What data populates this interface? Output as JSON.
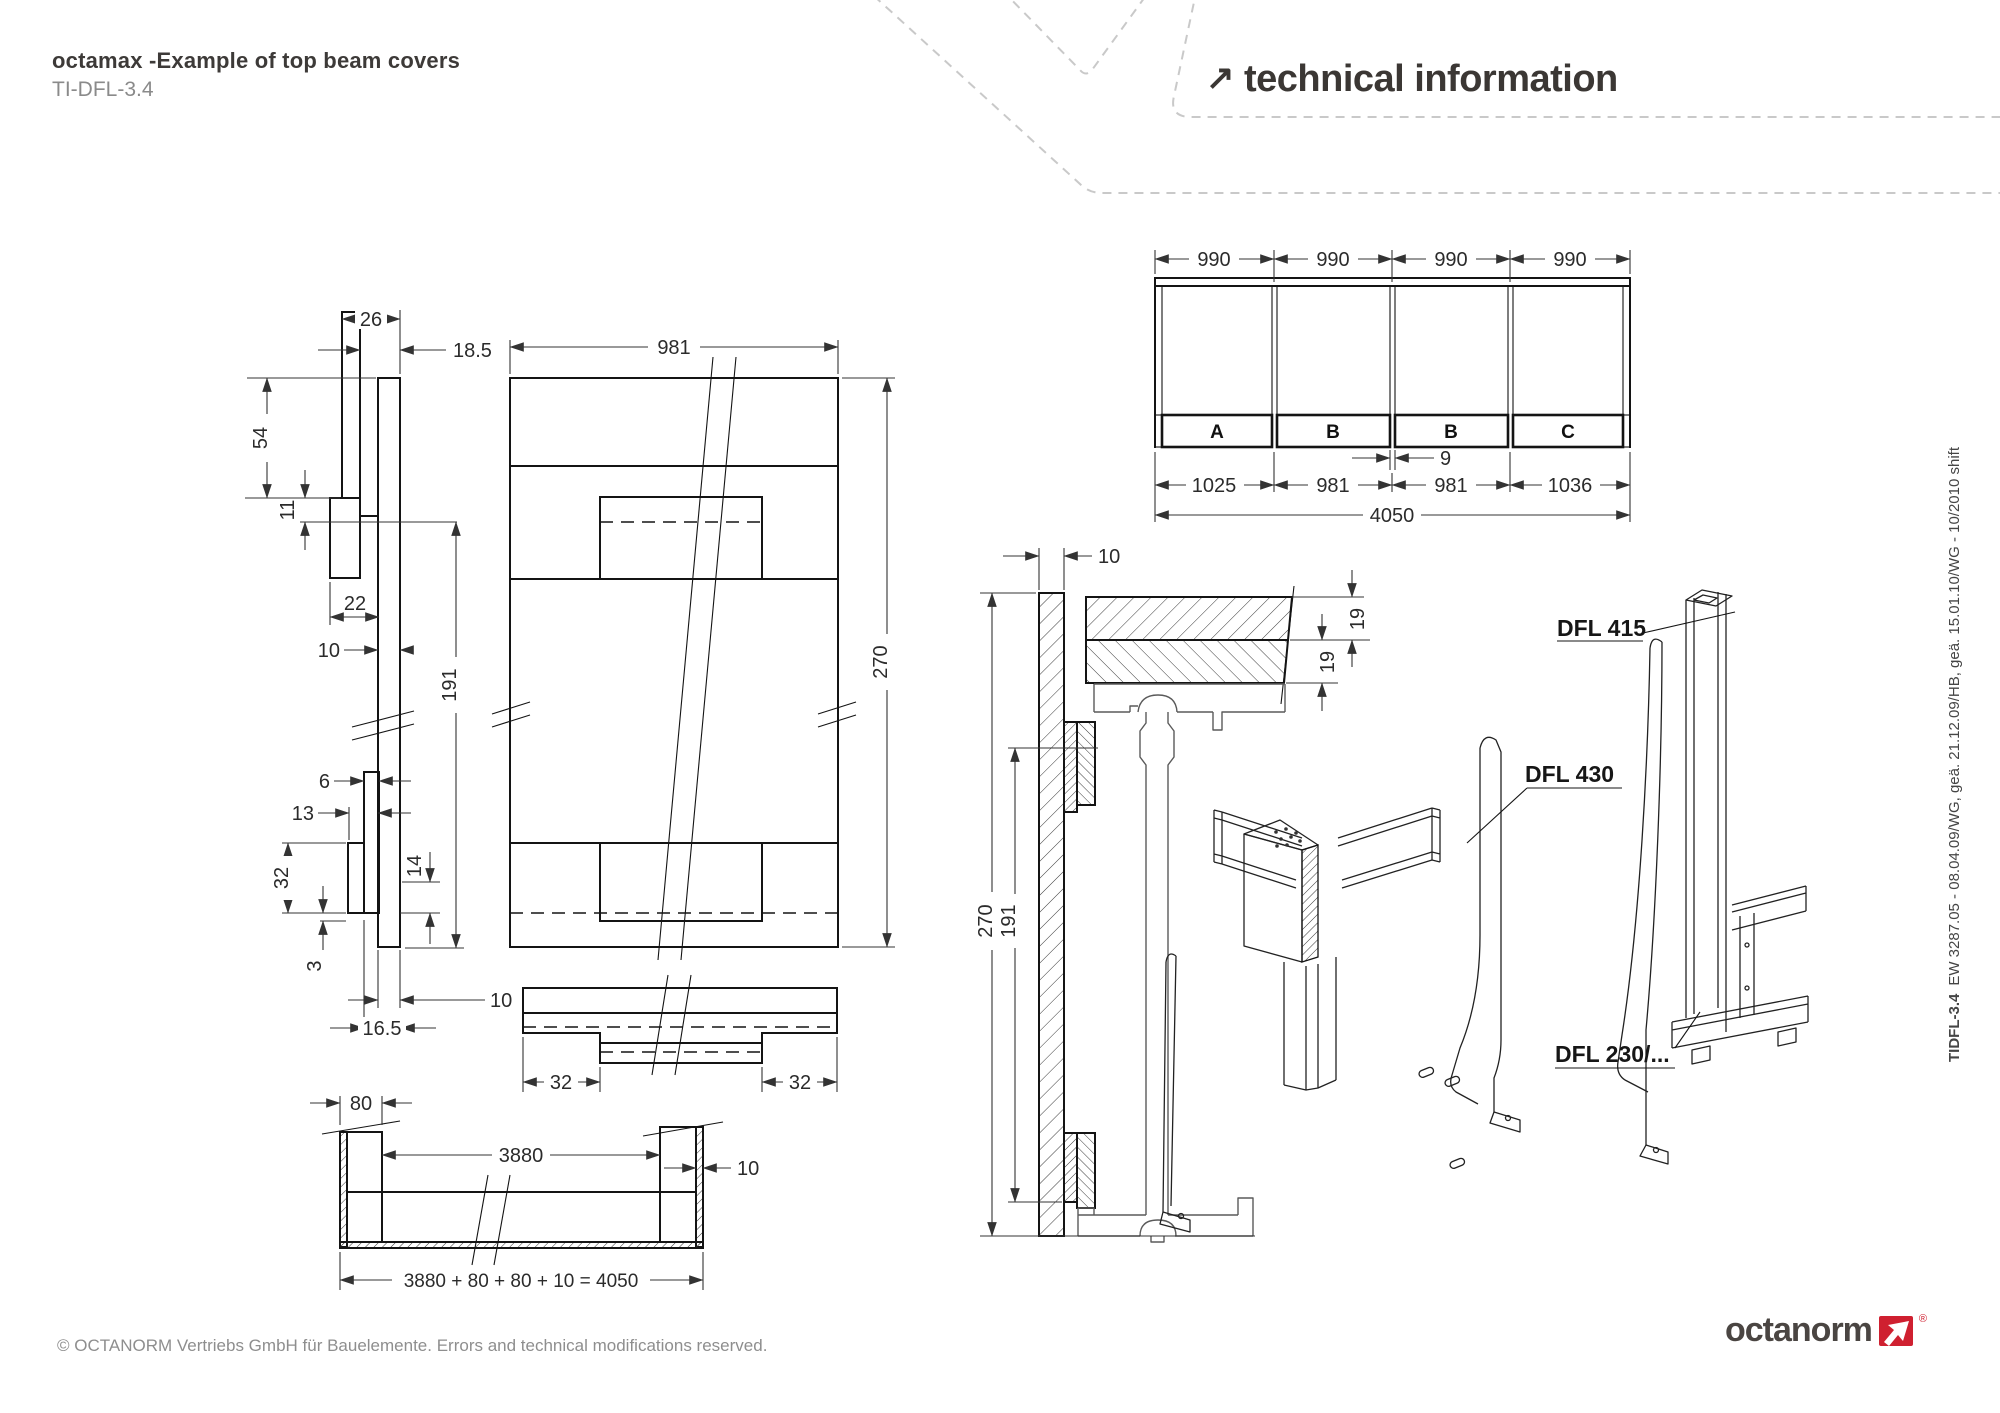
{
  "header": {
    "title": "octamax -Example of top beam covers",
    "doc_id": "TI-DFL-3.4",
    "arrow": "↗",
    "section_title": "technical information"
  },
  "sidebar_note": {
    "bold": "TIDFL-3.4",
    "text": "EW 3287.05 - 08.04.09/WG, geä. 21.12.09/HB, geä. 15.01.10/WG - 10/2010 shift"
  },
  "footer": {
    "copyright": "© OCTANORM Vertriebs GmbH für Bauelemente. Errors and technical modifications reserved.",
    "logo_text": "octanorm",
    "registered": "®"
  },
  "colors": {
    "brand_red": "#cf2030",
    "ink": "#141414",
    "muted": "#8e8e8e"
  },
  "profile_view": {
    "dims": {
      "d26": "26",
      "d18_5": "18.5",
      "d54": "54",
      "d11": "11",
      "d22": "22",
      "d10_mid": "10",
      "d191": "191",
      "d6": "6",
      "d13": "13",
      "d32": "32",
      "d3": "3",
      "d14": "14",
      "d10_bot": "10",
      "d16_5": "16.5"
    }
  },
  "front_view": {
    "dims": {
      "d981": "981",
      "d270": "270",
      "d32l": "32",
      "d32r": "32"
    }
  },
  "plan_view": {
    "dims": {
      "d80": "80",
      "d3880": "3880",
      "d10": "10",
      "formula": "3880  +  80  +  80  +  10  =  4050"
    }
  },
  "elevation_view": {
    "dims": {
      "d990": "990",
      "d1025": "1025",
      "d981": "981",
      "d1036": "1036",
      "d4050": "4050",
      "d9": "9"
    },
    "strips": {
      "a": "A",
      "b1": "B",
      "b2": "B",
      "c": "C"
    }
  },
  "section_view": {
    "dims": {
      "d10": "10",
      "d19a": "19",
      "d19b": "19",
      "d270": "270",
      "d191": "191"
    }
  },
  "parts": {
    "dfl415": "DFL 415",
    "dfl430": "DFL 430",
    "dfl230": "DFL 230/..."
  }
}
